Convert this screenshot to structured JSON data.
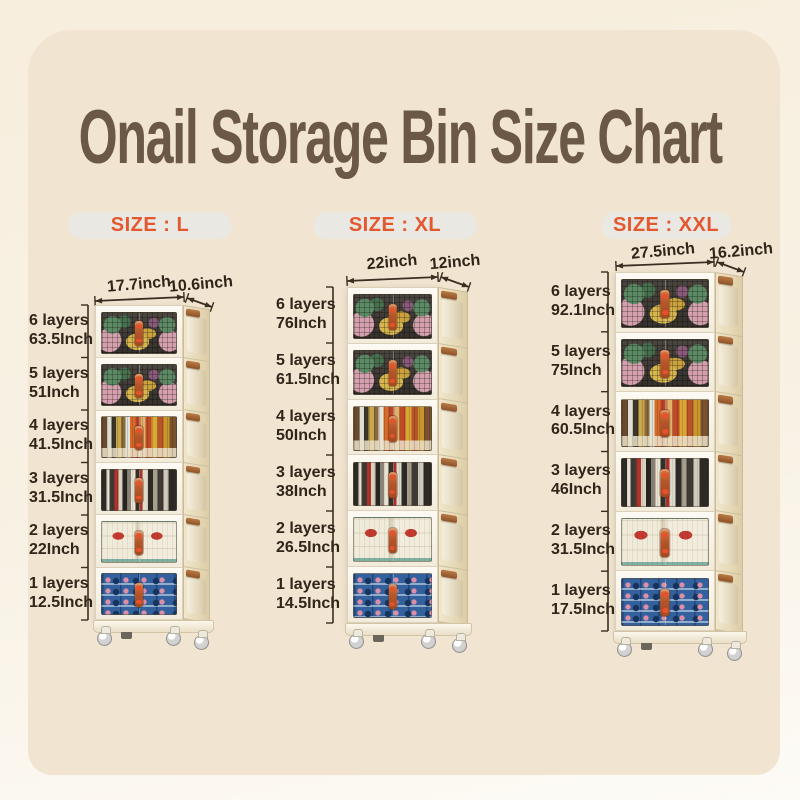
{
  "title": "Onail Storage Bin Size Chart",
  "colors": {
    "background_outer": "#f7eedd",
    "background_panel": "#f1e5d1",
    "title_text": "#6b5847",
    "size_label_text": "#e3582e",
    "size_pill_bg": "#e9e8e3",
    "measurement_text": "#2f2518",
    "cabinet_body": "#f7f2e6",
    "cabinet_side": "#e6d8b6",
    "handle_brown": "#a9653a"
  },
  "columns": [
    {
      "size_label": "SIZE : L",
      "width_label": "17.7inch",
      "depth_label": "10.6inch",
      "layers": [
        {
          "layers": "6 layers",
          "height": "63.5Inch"
        },
        {
          "layers": "5 layers",
          "height": "51Inch"
        },
        {
          "layers": "4 layers",
          "height": "41.5Inch"
        },
        {
          "layers": "3 layers",
          "height": "31.5Inch"
        },
        {
          "layers": "2 layers",
          "height": "22Inch"
        },
        {
          "layers": "1 layers",
          "height": "12.5Inch"
        }
      ]
    },
    {
      "size_label": "SIZE : XL",
      "width_label": "22inch",
      "depth_label": "12inch",
      "layers": [
        {
          "layers": "6 layers",
          "height": "76Inch"
        },
        {
          "layers": "5 layers",
          "height": "61.5Inch"
        },
        {
          "layers": "4 layers",
          "height": "50Inch"
        },
        {
          "layers": "3 layers",
          "height": "38Inch"
        },
        {
          "layers": "2 layers",
          "height": "26.5Inch"
        },
        {
          "layers": "1 layers",
          "height": "14.5Inch"
        }
      ]
    },
    {
      "size_label": "SIZE : XXL",
      "width_label": "27.5inch",
      "depth_label": "16.2inch",
      "layers": [
        {
          "layers": "6 layers",
          "height": "92.1Inch"
        },
        {
          "layers": "5 layers",
          "height": "75Inch"
        },
        {
          "layers": "4 layers",
          "height": "60.5Inch"
        },
        {
          "layers": "3 layers",
          "height": "46Inch"
        },
        {
          "layers": "2 layers",
          "height": "31.5Inch"
        },
        {
          "layers": "1 layers",
          "height": "17.5Inch"
        }
      ]
    }
  ]
}
